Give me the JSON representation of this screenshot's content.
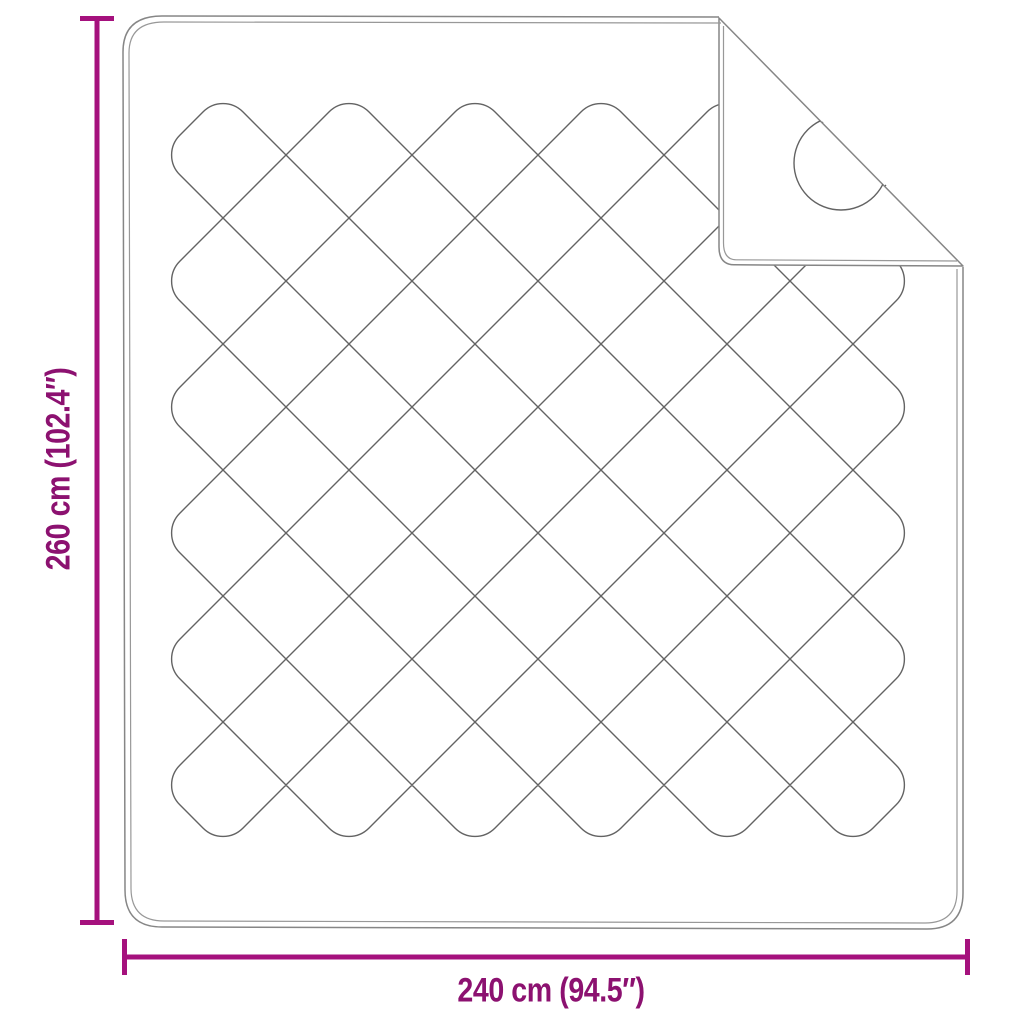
{
  "diagram": {
    "height_label": "260 cm (102.4″)",
    "width_label": "240 cm (94.5″)",
    "colors": {
      "dimension_line": "#A5117D",
      "dimension_text": "#8C1170",
      "outline": "#868686",
      "outline_inner": "#989898",
      "stitch": "#636363",
      "background": "#ffffff"
    }
  }
}
